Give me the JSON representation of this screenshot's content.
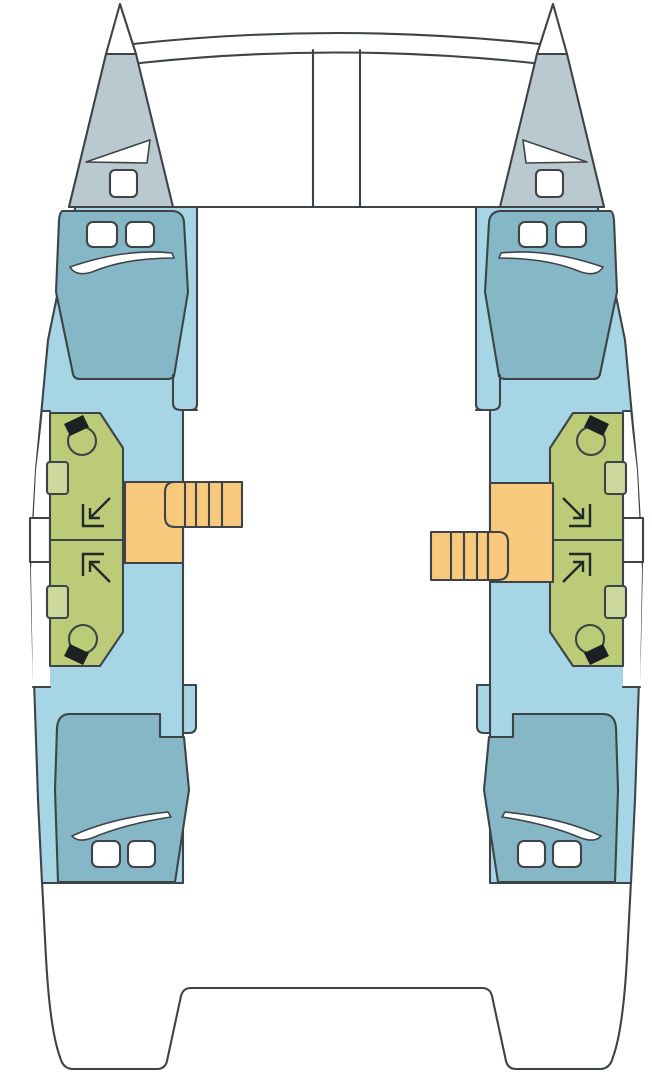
{
  "diagram": {
    "type": "catamaran-floor-plan",
    "view": "top-down deck layout",
    "hulls": 2,
    "cabins": 4,
    "bathrooms": 4,
    "companionway_stairs": 2
  },
  "colors": {
    "white": "#ffffff",
    "paper": "#ffffff",
    "stroke": "#3d4347",
    "symbol": "#24282a",
    "dark": "#1d2022",
    "forepeak_gray": "#b9c9cf",
    "hull_blue": "#a6d5e6",
    "bed_teal": "#85b7c7",
    "bathroom_green": "#bccb77",
    "sink_green": "#ccd89c",
    "stairs_orange": "#f8c97d"
  },
  "areas": {
    "port_hull": {
      "forepeak": "sail locker with deck hatch",
      "forward_cabin": "double berth with two pillows",
      "bathroom": "two shower/WC compartments",
      "aft_cabin": "double berth with two pillows",
      "stairs": "companionway steps to bridgedeck"
    },
    "starboard_hull": {
      "forepeak": "sail locker with deck hatch",
      "forward_cabin": "double berth with two pillows",
      "bathroom": "two shower/WC compartments",
      "aft_cabin": "double berth with two pillows",
      "stairs": "companionway steps to bridgedeck"
    },
    "center": {
      "bow": "trampoline frame with mast beam",
      "stern": "cockpit / transom platform"
    }
  }
}
